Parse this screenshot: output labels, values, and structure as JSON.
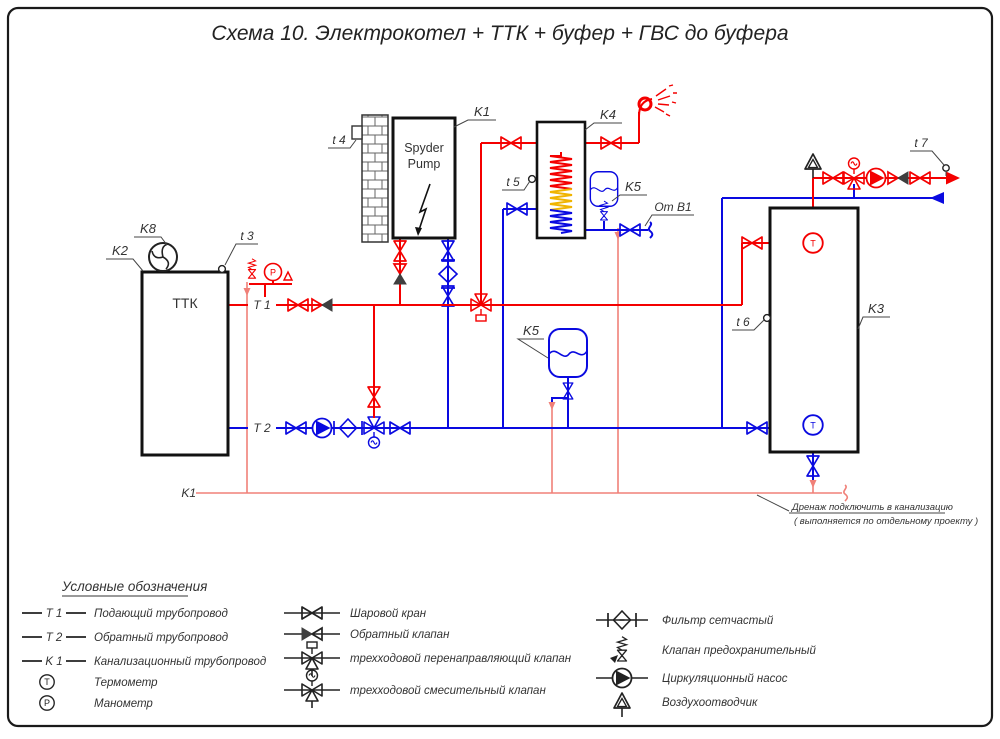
{
  "title": "Схема 10. Электрокотел + ТТК + буфер + ГВС до буфера",
  "equipment": {
    "boiler": {
      "tag": "K1",
      "line1": "Spyder",
      "line2": "Pump"
    },
    "ttk": {
      "tag": "K2",
      "label": "ТТК"
    },
    "fan": {
      "tag": "K8"
    },
    "dhw_tank": {
      "tag": "K4"
    },
    "expansion_dhw": {
      "tag": "K5"
    },
    "expansion_heating": {
      "tag": "K5"
    },
    "buffer": {
      "tag": "K3"
    }
  },
  "sensors": {
    "t3": "t 3",
    "t4": "t 4",
    "t5": "t 5",
    "t6": "t 6",
    "t7": "t 7"
  },
  "pipe_labels": {
    "supply": "T 1",
    "return": "T 2",
    "sewer": "K1",
    "cold_water": "От В1"
  },
  "gauges": {
    "thermometer": "T",
    "manometer": "P"
  },
  "note": {
    "line1": "Дренаж подключить в канализацию",
    "line2": "( выполняется по отдельному проекту )"
  },
  "legend": {
    "heading": "Условные обозначения",
    "pipes": [
      {
        "tag": "T 1",
        "label": "Подающий трубопровод"
      },
      {
        "tag": "T 2",
        "label": "Обратный трубопровод"
      },
      {
        "tag": "K 1",
        "label": "Канализационный трубопровод"
      }
    ],
    "instruments": [
      {
        "symbol": "T",
        "label": "Термометр"
      },
      {
        "symbol": "P",
        "label": "Манометр"
      }
    ],
    "valves": [
      "Шаровой кран",
      "Обратный клапан",
      "трехходовой перенаправляющий клапан",
      "трехходовой смесительный клапан"
    ],
    "devices": [
      "Фильтр сетчастый",
      "Клапан предохранительный",
      "Циркуляционный насос",
      "Воздухоотводчик"
    ]
  },
  "colors": {
    "supply": "#f40000",
    "return": "#0a0ae0",
    "drain": "#f08078",
    "outline": "#1a1a1a"
  }
}
